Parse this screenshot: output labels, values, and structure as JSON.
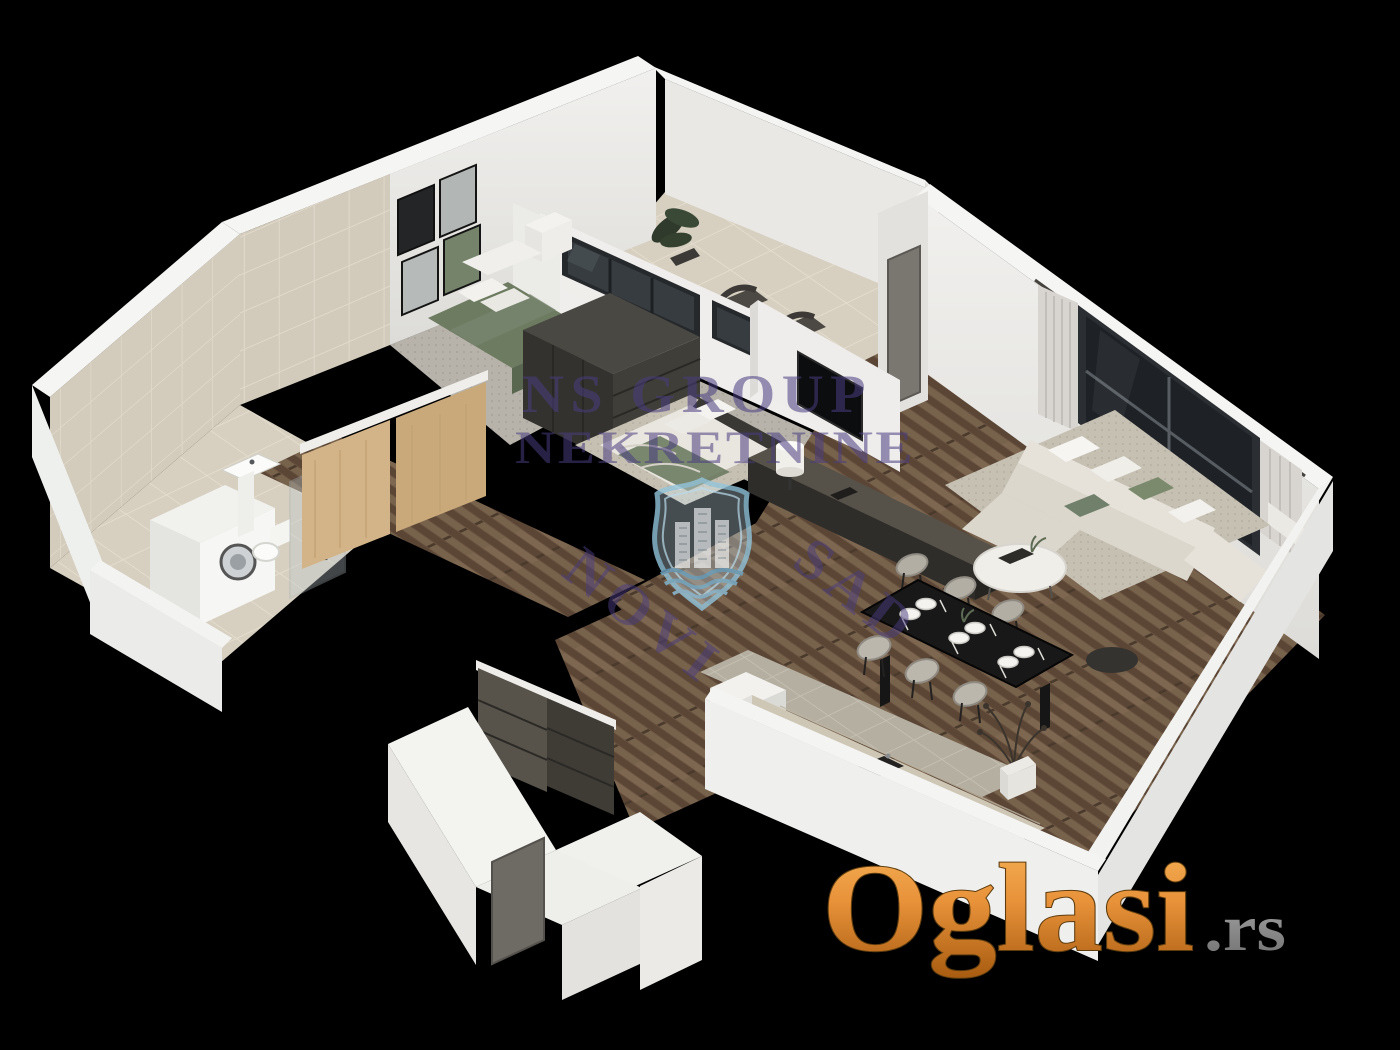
{
  "canvas": {
    "width": 1400,
    "height": 1050,
    "background": "#000000"
  },
  "scene": {
    "kind": "3d-isometric-floor-plan-render",
    "property_type": "two-bedroom apartment cutaway",
    "rooms": [
      {
        "name": "bathroom",
        "features": [
          "beige wall tiles",
          "washing machine",
          "pedestal sink",
          "walk-in shower",
          "toilet"
        ]
      },
      {
        "name": "bedroom",
        "features": [
          "green single bed",
          "four picture frames",
          "white nightstand",
          "gray carpet"
        ]
      },
      {
        "name": "master-bedroom",
        "features": [
          "double bed with green throw",
          "dark wardrobe bank",
          "wall tv",
          "beige area rug"
        ]
      },
      {
        "name": "terrace",
        "features": [
          "leafy potted plant",
          "two dark lounge chairs",
          "glass balustrade windows",
          "terrace door"
        ]
      },
      {
        "name": "living-room",
        "features": [
          "corner sofa with white and green pillows",
          "round coffee table",
          "gray rug",
          "large window with curtains",
          "dark sideboard with lamp",
          "black ottoman"
        ]
      },
      {
        "name": "dining-area",
        "features": [
          "black dining table",
          "six chairs",
          "six white place settings",
          "dry twig plant in white pot"
        ]
      },
      {
        "name": "kitchen",
        "features": [
          "stone counter with sink",
          "tall white cabinet",
          "gray tile floor"
        ]
      },
      {
        "name": "entrance-hall",
        "features": [
          "dark closet",
          "wood flooring",
          "entry door opening"
        ]
      }
    ],
    "palette": {
      "walls": "#efeeec",
      "wood_floor": "#6b5340",
      "carpet": "#b6b2a9",
      "tile": "#d6cfc0",
      "furniture_dark": "#3a3835",
      "bedding_green": "#6d7b61"
    }
  },
  "watermark": {
    "line1": "NS GROUP",
    "line2": "NEKRETNINE",
    "diagonal_word1": "NOVI",
    "diagonal_word2": "SAD",
    "color": "#4a3d80",
    "emblem": "novi-sad-shield-with-towers-and-waves"
  },
  "site_logo": {
    "brand": "Oglasi",
    "tld": ".rs",
    "brand_color_top": "#f2a24b",
    "brand_color_bottom": "#b4660f",
    "tld_color": "#8f8f8f"
  }
}
